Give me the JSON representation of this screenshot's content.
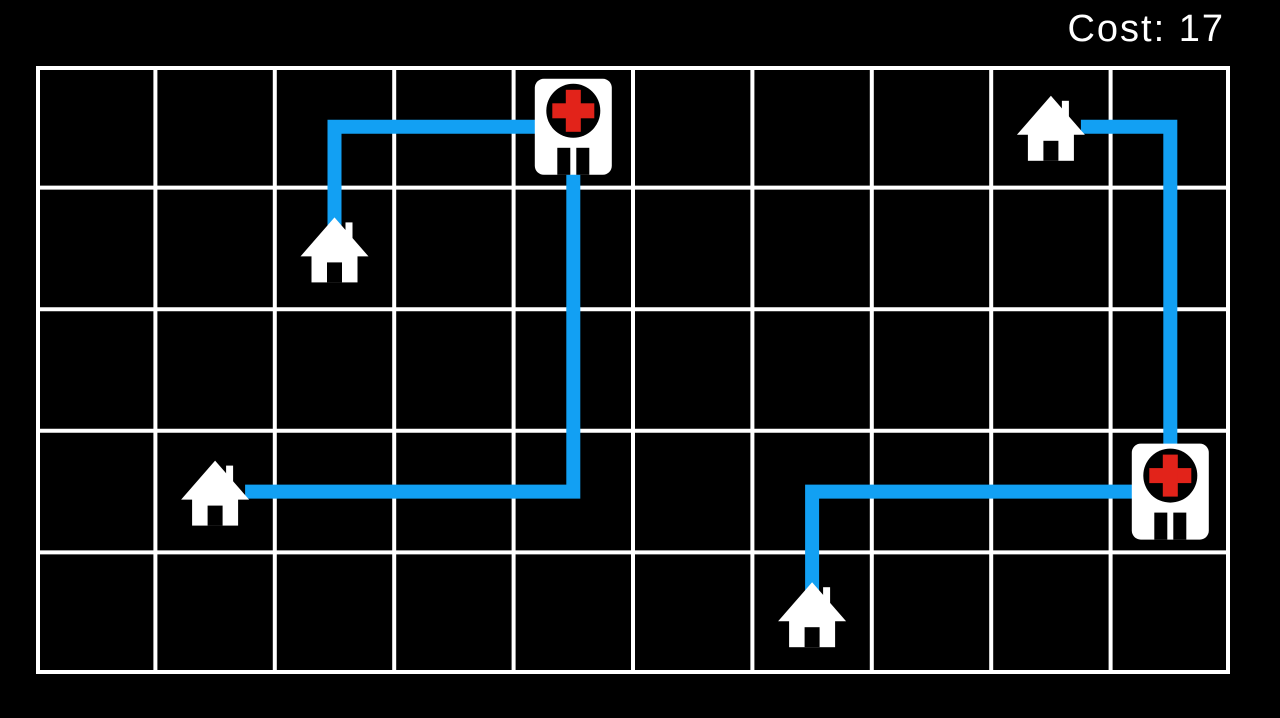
{
  "hud": {
    "cost_text": "Cost: 17",
    "cost_value": 17
  },
  "board": {
    "cols": 10,
    "rows": 5,
    "left": 36,
    "top": 66,
    "width": 1194,
    "height": 608,
    "grid_line_width": 4,
    "route_line_width": 14
  },
  "colors": {
    "background": "#000000",
    "grid": "#ffffff",
    "route_blue": "#12A0F3",
    "icon_white": "#ffffff",
    "cross_red": "#E2231A",
    "text": "#ffffff"
  },
  "entities": [
    {
      "type": "hospital",
      "name": "hospital-top",
      "col": 4,
      "row": 0
    },
    {
      "type": "hospital",
      "name": "hospital-right",
      "col": 9,
      "row": 3
    },
    {
      "type": "house",
      "name": "house-upper-left",
      "col": 2,
      "row": 1
    },
    {
      "type": "house",
      "name": "house-mid-left",
      "col": 1,
      "row": 3
    },
    {
      "type": "house",
      "name": "house-top-right",
      "col": 8,
      "row": 0
    },
    {
      "type": "house",
      "name": "house-bottom",
      "col": 6,
      "row": 4
    }
  ],
  "routes": [
    {
      "name": "hospital-top-to-house-upper-left",
      "from": "hospital-top",
      "to": "house-upper-left",
      "waypoints": [
        [
          4,
          0
        ],
        [
          2,
          0
        ],
        [
          2,
          1
        ]
      ]
    },
    {
      "name": "hospital-top-to-house-mid-left",
      "from": "hospital-top",
      "to": "house-mid-left",
      "waypoints": [
        [
          4,
          0
        ],
        [
          4,
          3
        ],
        [
          1,
          3
        ]
      ]
    },
    {
      "name": "hospital-right-to-house-top-right",
      "from": "hospital-right",
      "to": "house-top-right",
      "waypoints": [
        [
          9,
          3
        ],
        [
          9,
          0
        ],
        [
          8,
          0
        ]
      ]
    },
    {
      "name": "hospital-right-to-house-bottom",
      "from": "hospital-right",
      "to": "house-bottom",
      "waypoints": [
        [
          9,
          3
        ],
        [
          6,
          3
        ],
        [
          6,
          4
        ]
      ]
    }
  ]
}
